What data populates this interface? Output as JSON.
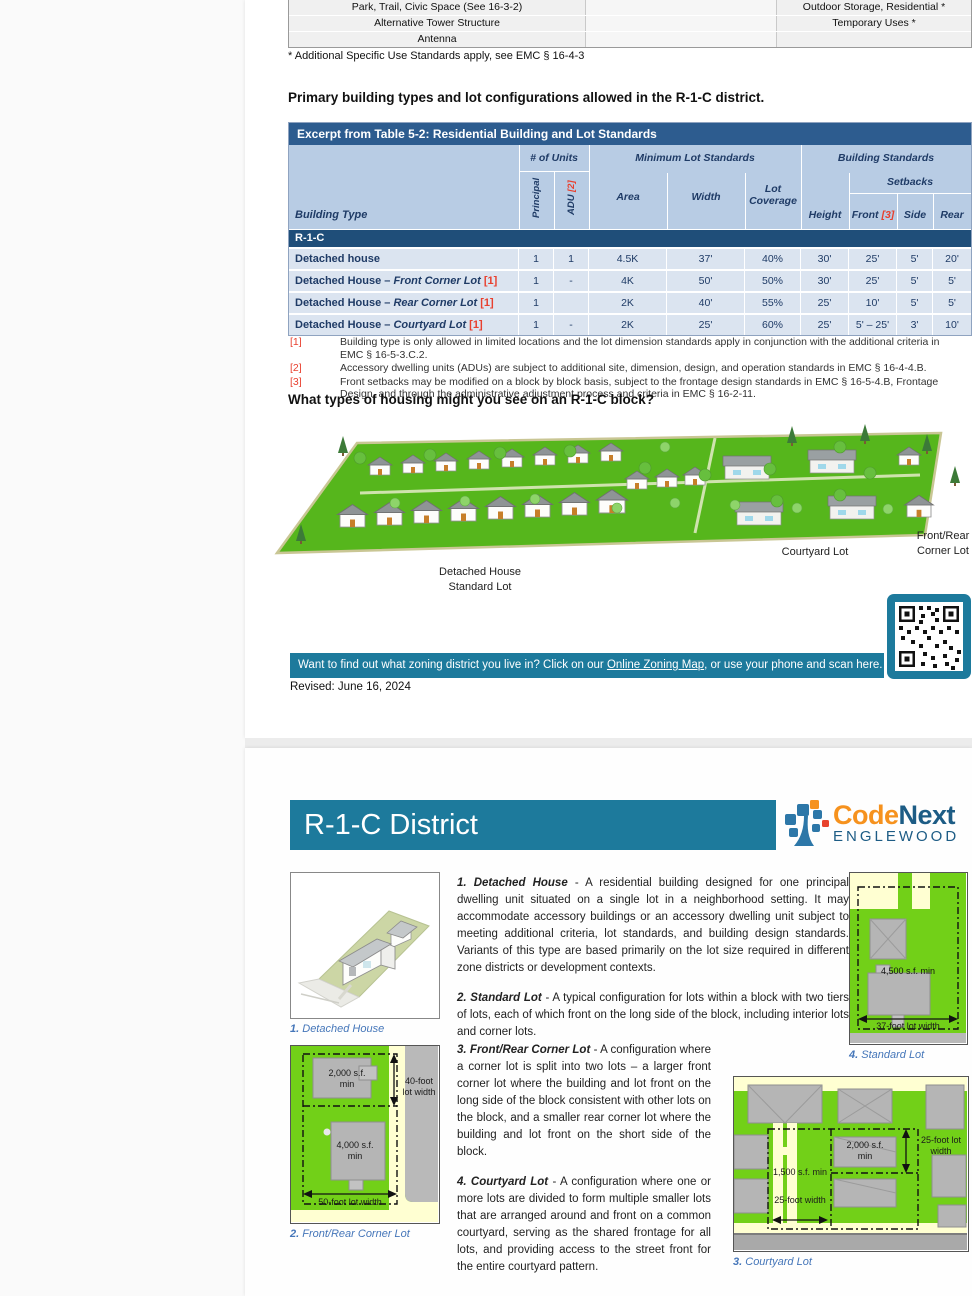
{
  "page1": {
    "use_table": {
      "rows": [
        {
          "left": "Park, Trail, Civic Space (See 16-3-2)",
          "mid": "",
          "right": "Outdoor Storage, Residential *"
        },
        {
          "left": "Alternative Tower Structure",
          "mid": "",
          "right": "Temporary Uses *"
        },
        {
          "left": "Antenna",
          "mid": "",
          "right": ""
        }
      ],
      "footnote": "* Additional Specific Use Standards apply, see EMC § 16-4-3"
    },
    "heading1": "Primary building types and lot configurations allowed in the R-1-C district.",
    "standards_table": {
      "title": "Excerpt from Table 5-2:  Residential Building and Lot Standards",
      "col_building_type": "Building Type",
      "group_units": "# of Units",
      "group_min_lot": "Minimum Lot Standards",
      "group_building": "Building Standards",
      "sub_setbacks": "Setbacks",
      "col_principal": "Principal",
      "col_adu": "ADU",
      "col_adu_ref": "[2]",
      "col_area": "Area",
      "col_width": "Width",
      "col_lot_coverage": "Lot Coverage",
      "col_height": "Height",
      "col_front": "Front",
      "col_front_ref": "[3]",
      "col_side": "Side",
      "col_rear": "Rear",
      "district_band": "R-1-C",
      "rows": [
        {
          "type": "Detached house",
          "type_italic": "",
          "ref": "",
          "principal": "1",
          "adu": "1",
          "area": "4.5K",
          "width": "37'",
          "coverage": "40%",
          "height": "30'",
          "front": "25'",
          "side": "5'",
          "rear": "20'"
        },
        {
          "type": "Detached House –",
          "type_italic": "Front Corner Lot",
          "ref": "[1]",
          "principal": "1",
          "adu": "-",
          "area": "4K",
          "width": "50'",
          "coverage": "50%",
          "height": "30'",
          "front": "25'",
          "side": "5'",
          "rear": "5'"
        },
        {
          "type": "Detached House –",
          "type_italic": "Rear Corner Lot",
          "ref": "[1]",
          "principal": "1",
          "adu": "",
          "area": "2K",
          "width": "40'",
          "coverage": "55%",
          "height": "25'",
          "front": "10'",
          "side": "5'",
          "rear": "5'"
        },
        {
          "type": "Detached House –",
          "type_italic": "Courtyard Lot",
          "ref": "[1]",
          "principal": "1",
          "adu": "-",
          "area": "2K",
          "width": "25'",
          "coverage": "60%",
          "height": "25'",
          "front": "5' – 25'",
          "side": "3'",
          "rear": "10'"
        }
      ],
      "footnotes": [
        {
          "marker": "[1]",
          "text": "Building type is only allowed in limited locations and the lot dimension standards apply in conjunction with the additional criteria in EMC § 16-5-3.C.2."
        },
        {
          "marker": "[2]",
          "text": "Accessory dwelling units (ADUs) are subject to additional site, dimension, design, and operation standards in EMC § 16-4-4.B."
        },
        {
          "marker": "[3]",
          "text": "Front setbacks may be modified on a block by block basis, subject to the frontage design standards in EMC § 16-5-4.B, Frontage Design, and through the administrative adjustment process and criteria in EMC § 16-2-11."
        }
      ]
    },
    "heading2": "What types of housing might you see on an R-1-C block?",
    "illustration_labels": {
      "detached_line1": "Detached House",
      "detached_line2": "Standard Lot",
      "courtyard": "Courtyard Lot",
      "front_rear_line1": "Front/Rear",
      "front_rear_line2": "Corner Lot"
    },
    "banner": {
      "text_before": "Want to find out what zoning district you live in?  Click on our ",
      "link": "Online Zoning Map",
      "text_after": ", or use your phone and scan here."
    },
    "revised": "Revised: June 16, 2024"
  },
  "page2": {
    "title": "R-1-C District",
    "logo": {
      "code": "Code",
      "next": "Next",
      "sub": "ENGLEWOOD"
    },
    "paragraphs": [
      {
        "lead": "1. Detached House",
        "body": " - A residential building designed for one principal dwelling unit situated on a single lot in a neighborhood setting.  It may accommodate accessory buildings or an accessory dwelling unit subject to meeting additional criteria, lot standards, and building design standards. Variants of this type are based primarily on the lot size required in different zone districts or development contexts."
      },
      {
        "lead": "2. Standard Lot",
        "body": " - A typical configuration for lots within a block with two tiers of lots, each of which front on the long side of the block, including interior lots and corner lots."
      },
      {
        "lead": "3. Front/Rear Corner Lot",
        "body": " - A configuration where a corner lot is split into two lots – a larger front corner lot where the building and lot front on the long side of the block consistent with other lots on the block, and a smaller rear corner lot where the building and lot front on the short side of the block."
      },
      {
        "lead": "4. Courtyard Lot",
        "body": " - A configuration where one or more lots are divided to form multiple smaller lots that are arranged around and front on a common courtyard, serving as the shared frontage for all lots, and providing access to the street front for the entire courtyard pattern."
      }
    ],
    "captions": {
      "detached": {
        "num": "1.",
        "label": " Detached House"
      },
      "front_rear": {
        "num": "2.",
        "label": " Front/Rear Corner Lot"
      },
      "courtyard": {
        "num": "3.",
        "label": " Courtyard Lot"
      },
      "standard": {
        "num": "4.",
        "label": " Standard Lot"
      }
    },
    "diagram_labels": {
      "fr_top_area": "2,000 s.f. min",
      "fr_lot_width_40": "40-foot lot width",
      "fr_bottom_area": "4,000 s.f. min",
      "fr_lot_width_50": "50-foot lot width",
      "std_area": "4,500 s.f. min",
      "std_width": "37-foot lot width",
      "cy_area_right": "2,000 s.f. min",
      "cy_area_left": "1,500 s.f. min",
      "cy_width": "25-foot width",
      "cy_lot_width": "25-foot lot width"
    }
  },
  "colors": {
    "accent_teal": "#1d7a9c",
    "table_title_blue": "#2d5c8f",
    "district_band_blue": "#1f4e79",
    "header_light_blue": "#b8cce4",
    "row_light_blue": "#dbe4f0",
    "footnote_red": "#e8402f",
    "diagram_green": "#72d018",
    "logo_orange": "#f6921e",
    "logo_blue": "#1d5c85"
  }
}
